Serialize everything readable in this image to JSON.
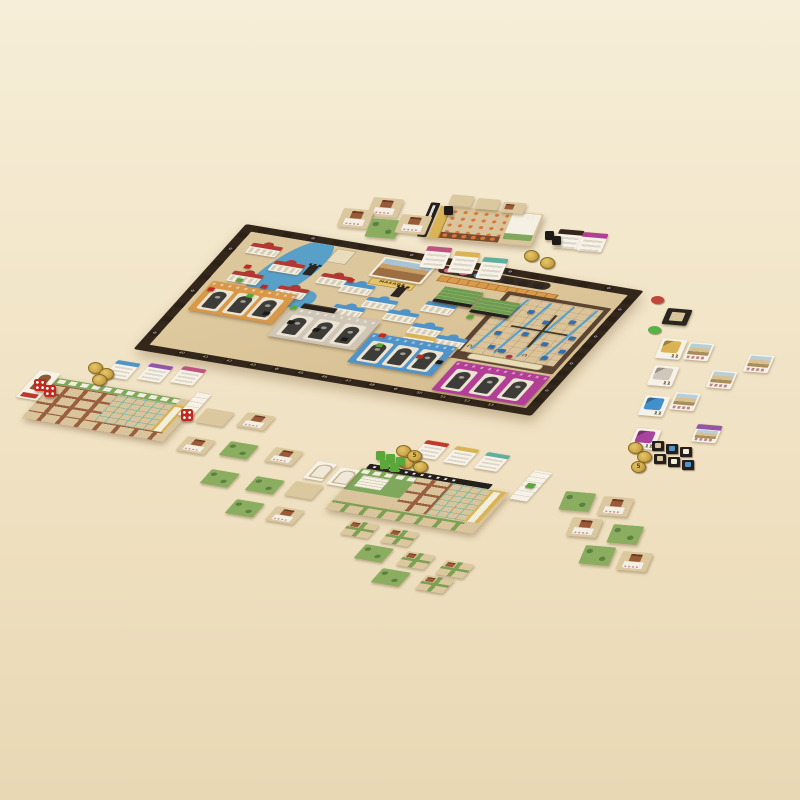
{
  "scene": {
    "description": "Tabletop photo of a Masada-themed board game fully set up: central map board with gate buildings and siege-ramp grid, four player boards, terrain tiles, tent cards, coins, dice and wooden cubes on a beige table",
    "background": "#f0e3c4"
  },
  "palette": {
    "tan": "#d9c49c",
    "borderBrown": "#33261b",
    "sea": "#58a0c8",
    "orange": "#d89848",
    "gray": "#cfc6b8",
    "blue": "#4f93c8",
    "magenta": "#b23e96",
    "green": "#7fa85c",
    "yellow": "#d9b354",
    "teal": "#5fae9e",
    "pink": "#c0527e",
    "purple": "#9455a8",
    "red": "#c0392b",
    "gold": "#c9a23f",
    "slate": "#241f1b",
    "cubeGreen": "#5aa839",
    "cubeRed": "#c1291f",
    "cubeBlue": "#2f6fb4",
    "rosette": "#c7a9e0",
    "cityRed": "#b03a33",
    "villageBlue": "#4f93c8"
  },
  "board": {
    "banner": "MASADA",
    "fortress_art": "masada-fortress-illustration",
    "round_discs": [
      "pink",
      "pink",
      "blue",
      "blue",
      "empty",
      "empty",
      "empty"
    ],
    "score_track_bottom_numbers": [
      "40",
      "41",
      "42",
      "43",
      "44",
      "45",
      "46",
      "47",
      "48",
      "49",
      "50",
      "51",
      "52",
      "53"
    ],
    "rosette_glyph": "✿",
    "arch_glyph": "∩ ∩ ∩ ∩",
    "gate_buildings": [
      {
        "name": "orange-gates",
        "color": "#d89848",
        "arch_count": 3
      },
      {
        "name": "stone-gates",
        "color": "#cfc6b8",
        "arch_count": 3
      },
      {
        "name": "blue-gates",
        "color": "#4f93c8",
        "arch_count": 3
      },
      {
        "name": "magenta-gates",
        "color": "#b23e96",
        "arch_count": 3
      }
    ],
    "red_city_count": 5,
    "village_card_count": 7
  },
  "market": {
    "tent_cards": [
      {
        "color_name": "yellow",
        "color": "#d9b354",
        "value": "11"
      },
      {
        "color_name": "white",
        "color": "#cec7ba",
        "value": "11"
      },
      {
        "color_name": "blue",
        "color": "#4190ca",
        "value": "11"
      },
      {
        "color_name": "purple",
        "color": "#a8439e",
        "value": "11"
      }
    ],
    "coin_value": "5"
  },
  "players": [
    {
      "seat": "top-right",
      "banner_cards": [
        "pink",
        "yellow",
        "teal"
      ]
    },
    {
      "seat": "left",
      "banner_cards": [
        "blue",
        "purple",
        "pink"
      ]
    },
    {
      "seat": "bottom-center",
      "banner_cards": [
        "red",
        "yellow",
        "teal"
      ]
    }
  ]
}
